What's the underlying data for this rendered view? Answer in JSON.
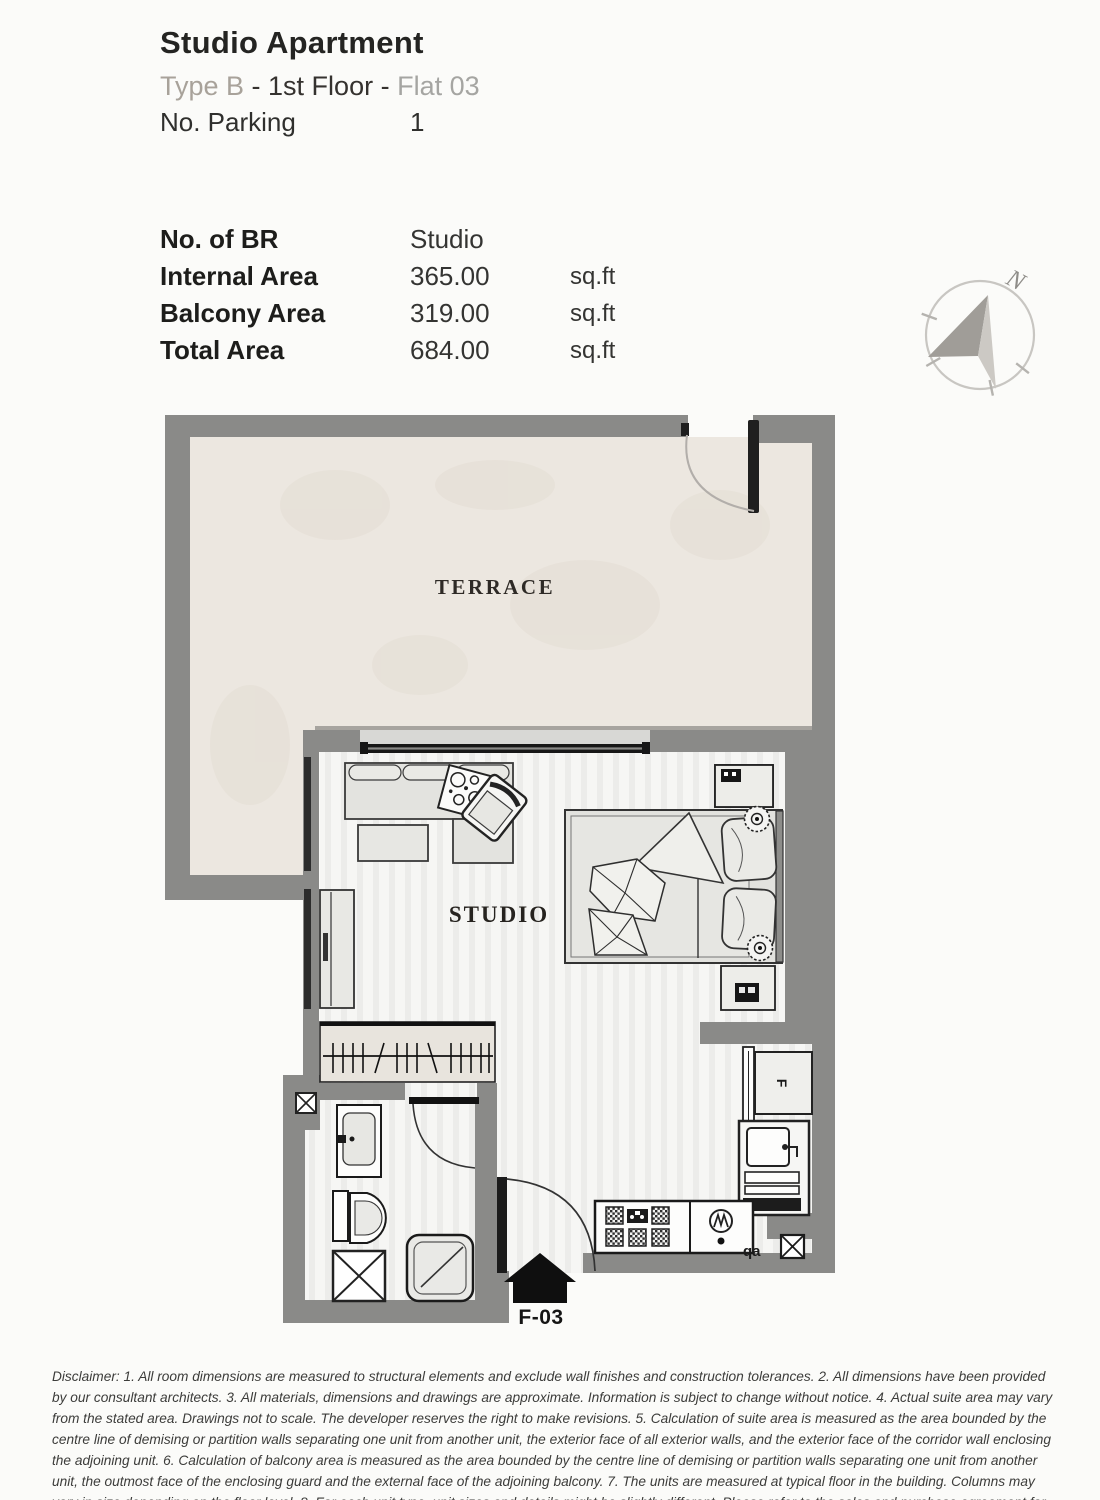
{
  "header": {
    "title": "Studio Apartment",
    "subtitle": {
      "type_label": "Type B",
      "middle": " - 1st Floor - ",
      "flat_label": "Flat 03"
    },
    "parking_label": "No. Parking",
    "parking_value": "1"
  },
  "area_table": {
    "rows": [
      {
        "label": "No. of BR",
        "value": "Studio",
        "unit": ""
      },
      {
        "label": "Internal Area",
        "value": "365.00",
        "unit": "sq.ft"
      },
      {
        "label": "Balcony Area",
        "value": "319.00",
        "unit": "sq.ft"
      },
      {
        "label": "Total Area",
        "value": "684.00",
        "unit": "sq.ft"
      }
    ]
  },
  "compass": {
    "north_label": "N"
  },
  "floor_plan": {
    "terrace_label": "TERRACE",
    "studio_label": "STUDIO",
    "unit_marker": "F-03",
    "fridge_label": "F",
    "kitchen_note": "qa"
  },
  "disclaimer": "Disclaimer: 1. All room dimensions are measured to structural elements and exclude wall finishes and construction tolerances. 2. All dimensions have been provided by our consultant architects. 3. All materials, dimensions and drawings are approximate. Information is subject to change without notice. 4. Actual suite area may vary from the stated area. Drawings not to scale. The developer reserves the right to make revisions. 5. Calculation of suite area is measured as the area bounded by the centre line of demising or partition walls separating one unit from another unit, the exterior face of all exterior walls, and the exterior face of the corridor wall enclosing the adjoining unit. 6. Calculation of balcony area is measured as the area bounded by the centre line of demising or partition walls separating one unit from another unit, the outmost face of the enclosing guard and the external face of the adjoining balcony. 7. The units are measured at typical floor in the building. Columns may vary in size depending on the floor level. 8. For each unit type, unit sizes and details might be slightly different. Please refer to the sales and purchase agreement for the actual size of each specific unit.",
  "colors": {
    "wall_gray": "#8a8a88",
    "terrace_floor": "#ece7e0",
    "room_floor": "#f6f6f4",
    "accent_tan": "#a8a29a",
    "text_dark": "#242422",
    "text_muted": "#a5a5a2"
  }
}
